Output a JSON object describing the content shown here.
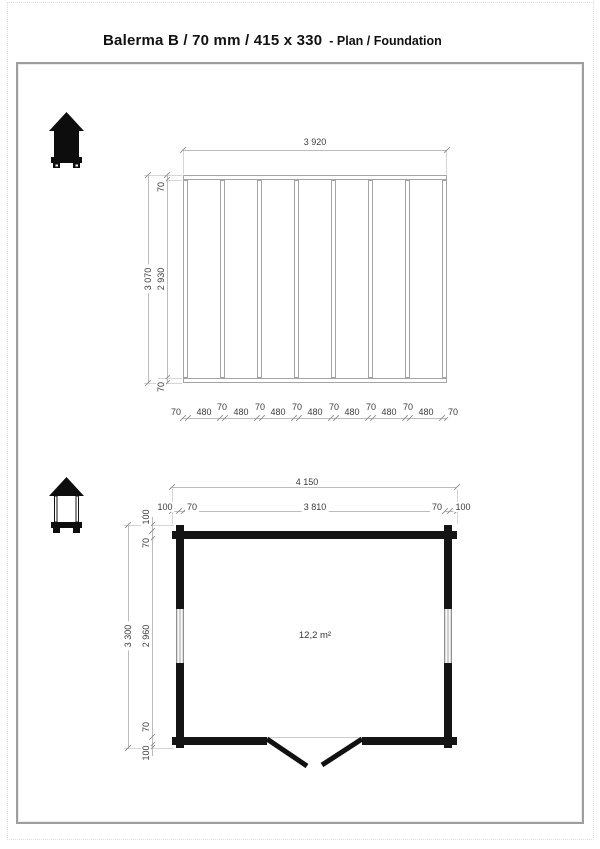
{
  "page": {
    "title_main": "Balerma B / 70 mm / 415 x 330",
    "title_sub": "- Plan / Foundation"
  },
  "foundation_plan": {
    "dim_width_total": "3 920",
    "dim_height_total": "3 070",
    "side_chain": [
      "70",
      "2 930",
      "70"
    ],
    "bottom_chain": [
      "70",
      "480",
      "70",
      "480",
      "70",
      "480",
      "70",
      "480",
      "70",
      "480",
      "70",
      "480",
      "70",
      "480",
      "70"
    ]
  },
  "floor_plan": {
    "dim_width_total": "4 150",
    "top_chain": [
      "100",
      "70",
      "3 810",
      "70",
      "100"
    ],
    "dim_height_total": "3 300",
    "side_chain": [
      "100",
      "70",
      "2 960",
      "70",
      "100"
    ],
    "area_label": "12,2 m²"
  },
  "colors": {
    "wall": "#141414",
    "foundation_line": "#a4a4a4",
    "dimension_line": "#bcbcbc",
    "dimension_text": "#3c3c3c"
  }
}
